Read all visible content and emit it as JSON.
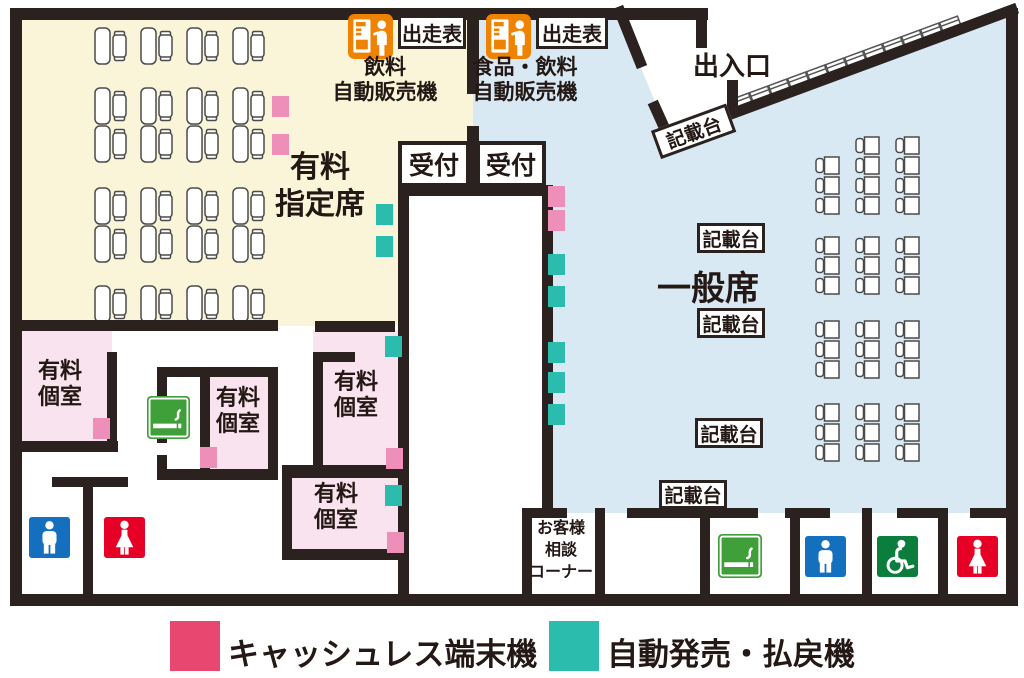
{
  "colors": {
    "wall": "#2b2220",
    "zone_paid_reserved": "#faf5d9",
    "zone_general": "#d8e9f4",
    "zone_paid_room": "#f8e3ee",
    "marker_cashless": "#ee8fba",
    "marker_ticket": "#2bbcae",
    "legend_cashless": "#e8476f",
    "legend_ticket": "#2bbcae",
    "vending_orange": "#ef8200",
    "toilet_male_blue": "#1470be",
    "toilet_female_red": "#e60026",
    "wheelchair_green": "#0b7e3e",
    "smoking_green": "#3fa039",
    "seat_stroke": "#4b4b4b"
  },
  "zones": {
    "paid_reserved": {
      "label_line1": "有料",
      "label_line2": "指定席"
    },
    "general": {
      "label": "一般席"
    },
    "entrance": {
      "label": "出入口"
    }
  },
  "vending": [
    {
      "label_line1": "飲料",
      "label_line2": "自動販売機",
      "racecard_label": "出走表"
    },
    {
      "label_line1": "食品・飲料",
      "label_line2": "自動販売機",
      "racecard_label": "出走表"
    }
  ],
  "reception": [
    {
      "label": "受付"
    },
    {
      "label": "受付"
    }
  ],
  "writing_stands": {
    "label": "記載台",
    "labeled_boxes": 5,
    "diagonal_stand_count": 12
  },
  "customer_corner": {
    "label_line1": "お客様",
    "label_line2": "相談",
    "label_line3": "コーナー"
  },
  "paid_rooms": [
    {
      "label_line1": "有料",
      "label_line2": "個室"
    },
    {
      "label_line1": "有料",
      "label_line2": "個室"
    },
    {
      "label_line1": "有料",
      "label_line2": "個室"
    },
    {
      "label_line1": "有料",
      "label_line2": "個室"
    }
  ],
  "legend": [
    {
      "label": "キャッシュレス端末機",
      "color": "#e8476f"
    },
    {
      "label": "自動発売・払戻機",
      "color": "#2bbcae"
    }
  ],
  "markers": {
    "cashless": [
      [
        272,
        96
      ],
      [
        272,
        134
      ],
      [
        548,
        186
      ],
      [
        548,
        210
      ],
      [
        93,
        418
      ],
      [
        200,
        447
      ],
      [
        386,
        448
      ],
      [
        387,
        532
      ]
    ],
    "ticket": [
      [
        376,
        204
      ],
      [
        376,
        236
      ],
      [
        548,
        254
      ],
      [
        548,
        286
      ],
      [
        548,
        342
      ],
      [
        548,
        372
      ],
      [
        548,
        404
      ],
      [
        385,
        336
      ],
      [
        385,
        485
      ]
    ]
  },
  "seating": {
    "paid_reserved_rows": {
      "row_ys": [
        28,
        88,
        126,
        188,
        226,
        286
      ],
      "units_per_row": 4,
      "x0": 95,
      "pitch": 46
    },
    "general_groups": [
      {
        "col_xs": [
          816,
          856,
          896
        ],
        "row_ys": [
          137,
          157,
          177,
          197
        ],
        "skip_first_row_col0": true
      },
      {
        "col_xs": [
          816,
          856,
          896
        ],
        "row_ys": [
          237,
          257,
          277
        ],
        "skip_first_row_col0": false
      },
      {
        "col_xs": [
          816,
          856,
          896
        ],
        "row_ys": [
          321,
          341,
          361
        ],
        "skip_first_row_col0": false
      },
      {
        "col_xs": [
          816,
          856,
          896
        ],
        "row_ys": [
          404,
          424,
          444
        ],
        "skip_first_row_col0": false
      }
    ]
  },
  "facility_icons": [
    {
      "type": "vending-machine",
      "x": 348,
      "y": 14,
      "s": 45
    },
    {
      "type": "vending-machine",
      "x": 486,
      "y": 14,
      "s": 45
    },
    {
      "type": "smoking-area",
      "x": 147,
      "y": 396,
      "s": 43
    },
    {
      "type": "smoking-area",
      "x": 718,
      "y": 534,
      "s": 44
    },
    {
      "type": "mens-toilet",
      "x": 29,
      "y": 517,
      "s": 41
    },
    {
      "type": "mens-toilet",
      "x": 805,
      "y": 536,
      "s": 41
    },
    {
      "type": "womens-toilet",
      "x": 104,
      "y": 517,
      "s": 41
    },
    {
      "type": "womens-toilet",
      "x": 957,
      "y": 536,
      "s": 41
    },
    {
      "type": "wheelchair",
      "x": 877,
      "y": 536,
      "s": 41
    }
  ]
}
